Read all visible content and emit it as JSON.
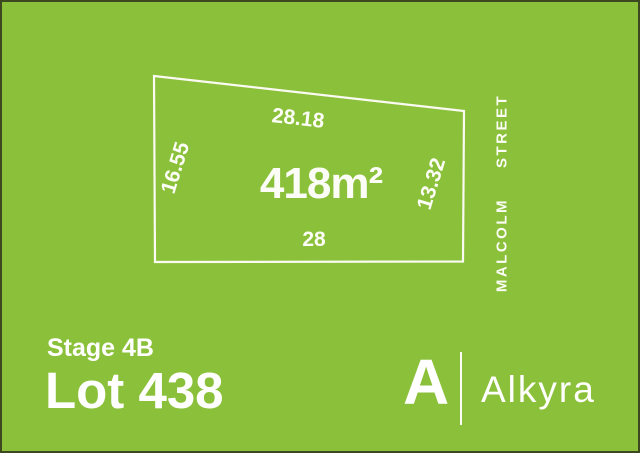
{
  "colors": {
    "background": "#8bc13a",
    "border": "#3d4820",
    "text": "#ffffff",
    "boundary": "#fafaf2"
  },
  "diagram": {
    "area": "418m²",
    "dimensions": {
      "top": "28.18",
      "left": "16.55",
      "right": "13.32",
      "bottom": "28"
    },
    "street": {
      "word1": "MALCOLM",
      "word2": "STREET"
    }
  },
  "labels": {
    "stage": "Stage 4B",
    "lot": "Lot 438"
  },
  "brand": {
    "initial": "A",
    "name": "Alkyra"
  }
}
